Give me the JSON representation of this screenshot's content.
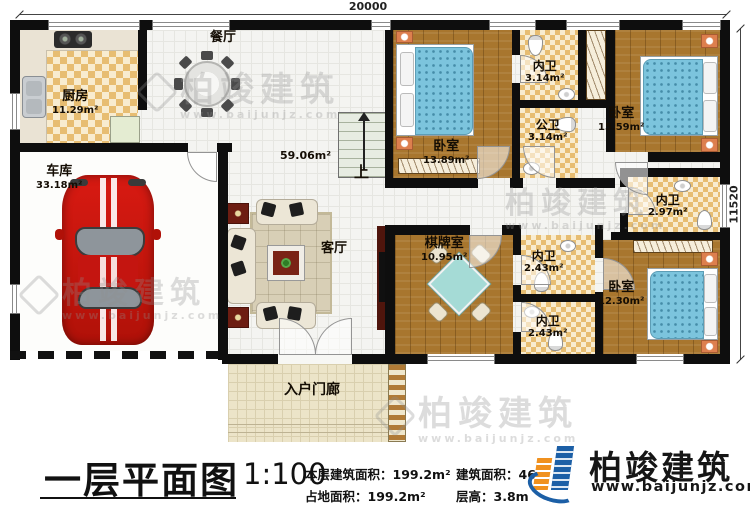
{
  "dimensions": {
    "width_mm": "20000",
    "height_mm": "11520"
  },
  "rooms": {
    "kitchen": {
      "name": "厨房",
      "area": "11.29m²"
    },
    "dining": {
      "name": "餐厅"
    },
    "garage": {
      "name": "车库",
      "area": "33.18m²"
    },
    "hall": {
      "name": "客厅",
      "area": "59.06m²"
    },
    "stairs": {
      "label": "上"
    },
    "bedroom1": {
      "name": "卧室",
      "area": "13.89m²"
    },
    "ensuite1": {
      "name": "内卫",
      "area": "3.14m²"
    },
    "publicbath": {
      "name": "公卫",
      "area": "3.14m²"
    },
    "bedroom2": {
      "name": "卧室",
      "area": "15.59m²"
    },
    "ensuite2": {
      "name": "内卫",
      "area": "2.97m²"
    },
    "bedroom3": {
      "name": "卧室",
      "area": "12.30m²"
    },
    "chessroom": {
      "name": "棋牌室",
      "area": "10.95m²"
    },
    "ensuite3": {
      "name": "内卫",
      "area": "2.43m²"
    },
    "ensuite4": {
      "name": "内卫",
      "area": "2.43m²"
    },
    "porch": {
      "name": "入户门廊"
    }
  },
  "titleblock": {
    "title": "一层平面图",
    "scale": "1:100",
    "floor_built_area": "本层建筑面积：199.2m²",
    "land_area": "占地面积：199.2m²",
    "total_built_area": "建筑面积：462",
    "floor_height": "层高：3.8m"
  },
  "brand": {
    "name": "柏竣建筑",
    "website": "www.baijunjz.com"
  },
  "colors": {
    "wall": "#0e0e0e",
    "wood_floor": "#a8762e",
    "tile_check": "#e7bd72",
    "bed_blue": "#7cc4dd",
    "car_red": "#c8170f",
    "brand_blue": "#1c5fa6",
    "brand_orange": "#f0911f",
    "watermark_gray": "#8f8f8f"
  }
}
